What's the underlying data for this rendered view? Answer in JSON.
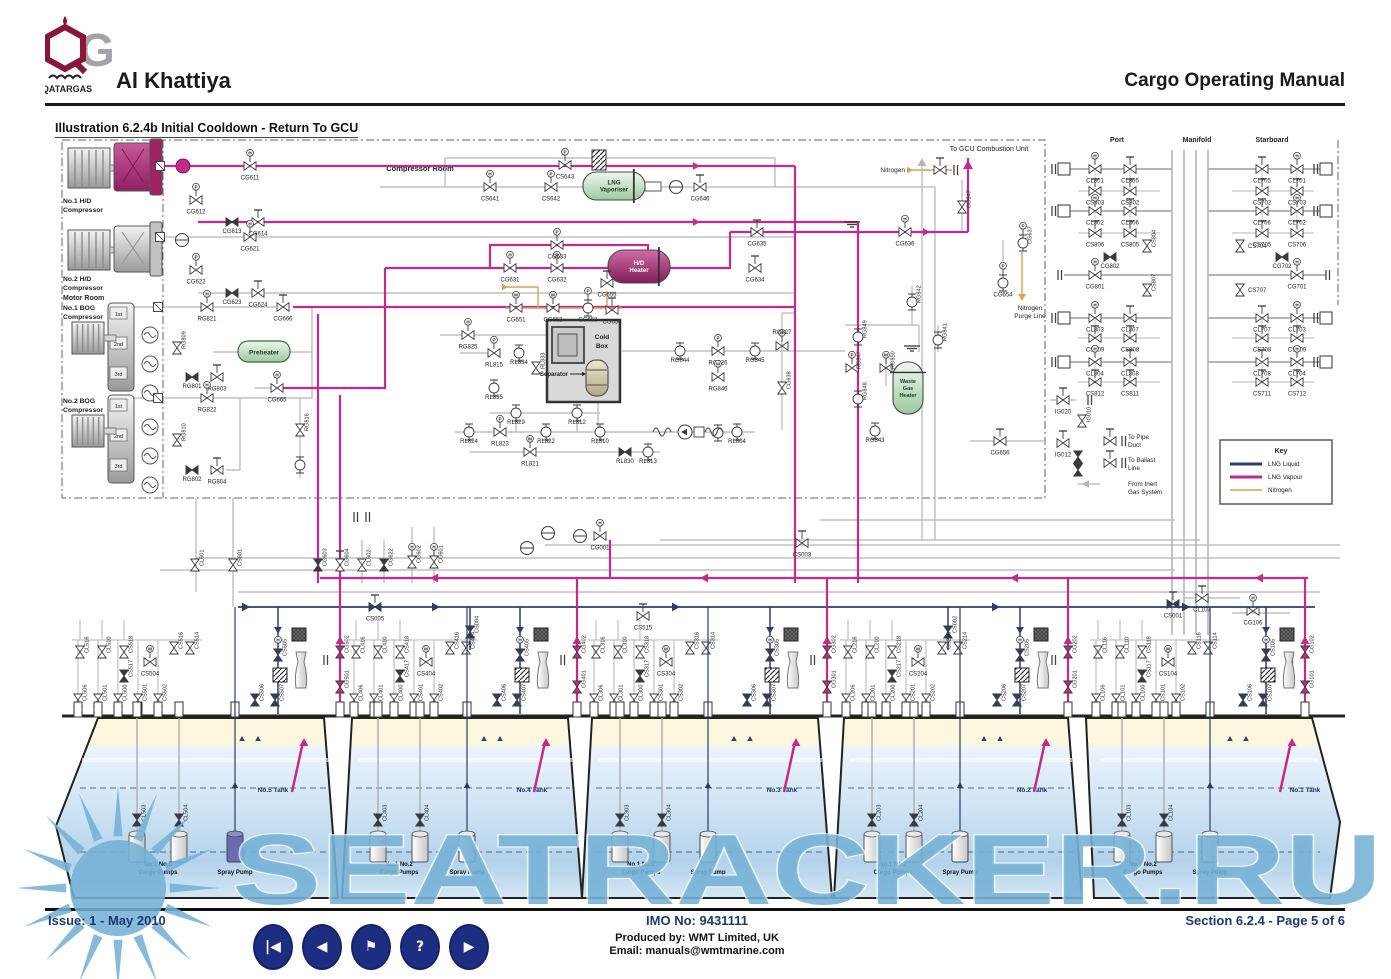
{
  "header": {
    "arabic": "قطرغاز",
    "logo_brand": "QATARGAS",
    "ship_name": "Al Khattiya",
    "manual_title": "Cargo Operating Manual"
  },
  "illustration_title": "Illustration 6.2.4b Initial Cooldown - Return To GCU",
  "watermark": "SEATRACKER.RU",
  "footer": {
    "issue": "Issue: 1  -  May 2010",
    "imo": "IMO No: 9431111",
    "produced_by": "Produced by: WMT Limited, UK",
    "email": "Email: manuals@wmtmarine.com",
    "section": "Section 6.2.4 - Page 5 of 6",
    "nav": [
      {
        "name": "first-page",
        "glyph": "|◀"
      },
      {
        "name": "previous-page",
        "glyph": "◀"
      },
      {
        "name": "bookmark",
        "glyph": "⚑"
      },
      {
        "name": "help",
        "glyph": "?"
      },
      {
        "name": "next-page",
        "glyph": "▶"
      }
    ]
  },
  "key": {
    "title": "Key",
    "entries": [
      {
        "label": "LNG Liquid",
        "color": "#2c3e6d"
      },
      {
        "label": "LNG Vapour",
        "color": "#c42a8c"
      },
      {
        "label": "Nitrogen",
        "color": "#dc9f57"
      }
    ]
  },
  "rooms": {
    "compressor_room": "Compressor Room",
    "motor_room": "Motor Room"
  },
  "notes": {
    "to_gcu": "To GCU Combustion Unit",
    "nitrogen": "Nitrogen",
    "nitrogen_purge": [
      "Nitrogen",
      "Purge Line"
    ],
    "to_pipe_duct": [
      "To Pipe",
      "Duct"
    ],
    "to_ballast": [
      "To Ballast",
      "Line"
    ],
    "from_inert": [
      "From Inert",
      "Gas System"
    ],
    "port": "Port",
    "manifold": "Manifold",
    "starboard": "Starboard"
  },
  "machinery": {
    "hd1": [
      "No.1 H/D",
      "Compressor"
    ],
    "hd2": [
      "No.2 H/D",
      "Compressor"
    ],
    "bog1": [
      "No.1 BOG",
      "Compressor"
    ],
    "bog2": [
      "No.2 BOG",
      "Compressor"
    ],
    "stages": [
      "1st",
      "2nd",
      "3rd"
    ],
    "preheater": "Preheater",
    "lng_vaporiser": [
      "LNG",
      "Vaporiser"
    ],
    "hd_heater": [
      "H/D",
      "Heater"
    ],
    "cold_box": [
      "Cold",
      "Box"
    ],
    "separator": "Separator",
    "waste_gas_heater": [
      "Waste",
      "Gas",
      "Heater"
    ]
  },
  "valves": {
    "hd1": [
      "CG611",
      "CG612",
      "CG613",
      "CG614"
    ],
    "hd2": [
      "CG621",
      "CG622",
      "CG623",
      "CG624"
    ],
    "bog1": [
      "RG821",
      "CG666",
      "RG809",
      "RG801",
      "RG803",
      "CG665"
    ],
    "bog2": [
      "RG822",
      "RG810",
      "RG802",
      "RG804",
      "RG816"
    ],
    "vaporiser_row": [
      "CS641",
      "CS642",
      "CS643",
      "CG646"
    ],
    "heater_rows": [
      "CG631",
      "CG632",
      "CG633",
      "CG634",
      "CG635",
      "CG636",
      "CG647",
      "CG637",
      "CG654"
    ],
    "coldbox_top": [
      "CG651",
      "CG652",
      "CG653",
      "CG654",
      "CG655"
    ],
    "coldbox_left": [
      "RG825",
      "RL815",
      "RL834",
      "RL833",
      "RL835"
    ],
    "coldbox_bottom": [
      "RL829",
      "RL812",
      "RL824",
      "RL823",
      "RL822",
      "RL821",
      "RL810",
      "RL830",
      "RL813",
      "RL804"
    ],
    "regas": [
      "RG827",
      "CG638",
      "RG844",
      "RG826",
      "RG845",
      "RG846",
      "RG849",
      "RG847",
      "RG848",
      "RG850",
      "RG842",
      "RG841",
      "RG843",
      "CG656"
    ],
    "inert": [
      "IG020",
      "IG010",
      "IG012"
    ],
    "midband": [
      "CL601",
      "CS601",
      "CG603",
      "CG604",
      "CL602",
      "CG622",
      "CG602",
      "CG601",
      "CG001",
      "CS005",
      "CS003",
      "CS002",
      "CS001",
      "CS515",
      "CL107",
      "CG106",
      "CS004"
    ],
    "manifold_port": [
      [
        "CL801",
        "CL805"
      ],
      [
        "CS803",
        "CS802"
      ],
      [
        "CL802",
        "CL806"
      ],
      [
        "CS806",
        "CS805"
      ],
      [
        "CL803",
        "CL807"
      ],
      [
        "CS809",
        "CS808"
      ],
      [
        "CL804",
        "CL808"
      ],
      [
        "CS812",
        "CS811"
      ]
    ],
    "manifold_port_single": [
      "CS804",
      "CG802",
      "CG801",
      "CS807"
    ],
    "manifold_stbd": [
      [
        "CL705",
        "CL701"
      ],
      [
        "CS702",
        "CS703"
      ],
      [
        "CL706",
        "CL702"
      ],
      [
        "CS705",
        "CS706"
      ],
      [
        "CL707",
        "CL703"
      ],
      [
        "CS708",
        "CS709"
      ],
      [
        "CL708",
        "CL704"
      ],
      [
        "CS711",
        "CS712"
      ]
    ],
    "manifold_stbd_single": [
      "CS704",
      "CG702",
      "CG701",
      "CS707"
    ]
  },
  "tanks": {
    "names": [
      "No.5 Tank",
      "No.4 Tank",
      "No.3 Tank",
      "No.2 Tank",
      "No.1 Tank"
    ],
    "cargo_pumps": [
      "No.1  No.2",
      "Cargo Pumps"
    ],
    "spray_pump": "Spray Pump",
    "clusters": {
      "t5": [
        "CL516",
        "CL510",
        "CS518",
        "CS517",
        "CS504",
        "CS516",
        "CS514",
        "CS505",
        "CL506",
        "CL501",
        "CL500",
        "CS501",
        "CS502",
        "CS506",
        "CS507"
      ],
      "t4": [
        "CL416",
        "CL410",
        "CS418",
        "CS417",
        "CS404",
        "CS416",
        "CS414",
        "CS405",
        "CL406",
        "CL401",
        "CL400",
        "CS401",
        "CS402",
        "CS406",
        "CS407"
      ],
      "t3": [
        "CL316",
        "CL310",
        "CS318",
        "CS317",
        "CS304",
        "CS316",
        "CS314",
        "CS305",
        "CL306",
        "CL301",
        "CL300",
        "CS301",
        "CS302",
        "CS306",
        "CS307"
      ],
      "t2": [
        "CL216",
        "CL210",
        "CS218",
        "CS217",
        "CS204",
        "CS216",
        "CS214",
        "CS205",
        "CL206",
        "CL201",
        "CL200",
        "CS201",
        "CS202",
        "CS206",
        "CS207"
      ],
      "t1": [
        "CL116",
        "CL110",
        "CS118",
        "CS117",
        "CS104",
        "CS116",
        "CS114",
        "CS105",
        "CL106",
        "CL101",
        "CL100",
        "CS101",
        "CS102",
        "CS106",
        "CS107"
      ]
    },
    "cg": {
      "t5": [
        "CG502",
        "CG501"
      ],
      "t4": [
        "CG402",
        "CG401"
      ],
      "t3": [
        "CG302",
        "CG301"
      ],
      "t2": [
        "CG202",
        "CG201"
      ],
      "t1": [
        "CG102",
        "CG101"
      ]
    },
    "pump_valves": {
      "t5": [
        "CL503",
        "CL504"
      ],
      "t4": [
        "CL403",
        "CL404"
      ],
      "t3": [
        "CL303",
        "CL304"
      ],
      "t2": [
        "CL203",
        "CL204"
      ],
      "t1": [
        "CL103",
        "CL104"
      ]
    }
  }
}
